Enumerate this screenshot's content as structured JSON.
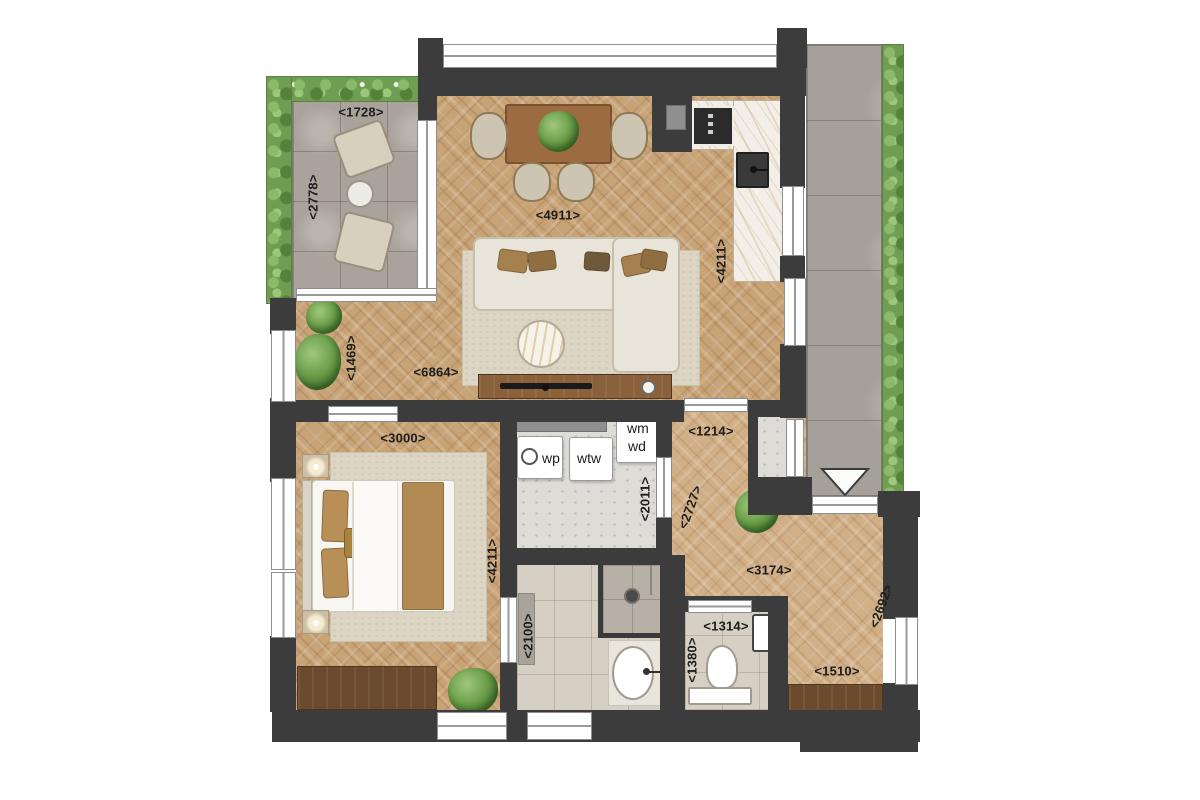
{
  "floorplan": {
    "dimensions": [
      {
        "id": "terrace-width",
        "text": "<1728>"
      },
      {
        "id": "terrace-depth",
        "text": "<2778>"
      },
      {
        "id": "living-width",
        "text": "<4911>"
      },
      {
        "id": "kitchen-length",
        "text": "<4211>"
      },
      {
        "id": "living-left-width",
        "text": "<1469>"
      },
      {
        "id": "living-length",
        "text": "<6864>"
      },
      {
        "id": "bedroom-width",
        "text": "<3000>"
      },
      {
        "id": "bedroom-length",
        "text": "<4211>"
      },
      {
        "id": "tech-room-width",
        "text": "<2011>"
      },
      {
        "id": "hall-top-width",
        "text": "<1214>"
      },
      {
        "id": "hall-corridor-length",
        "text": "<2727>"
      },
      {
        "id": "hall-width",
        "text": "<3174>"
      },
      {
        "id": "hall-right-length",
        "text": "<2692>"
      },
      {
        "id": "hall-bottom-width",
        "text": "<1510>"
      },
      {
        "id": "bathroom-width",
        "text": "<2100>"
      },
      {
        "id": "toilet-width",
        "text": "<1314>"
      },
      {
        "id": "toilet-depth",
        "text": "<1380>"
      }
    ],
    "appliances": {
      "heat_pump": "wp",
      "heat_recovery": "wtw",
      "washing_machine": "wm",
      "dryer": "wd"
    }
  }
}
